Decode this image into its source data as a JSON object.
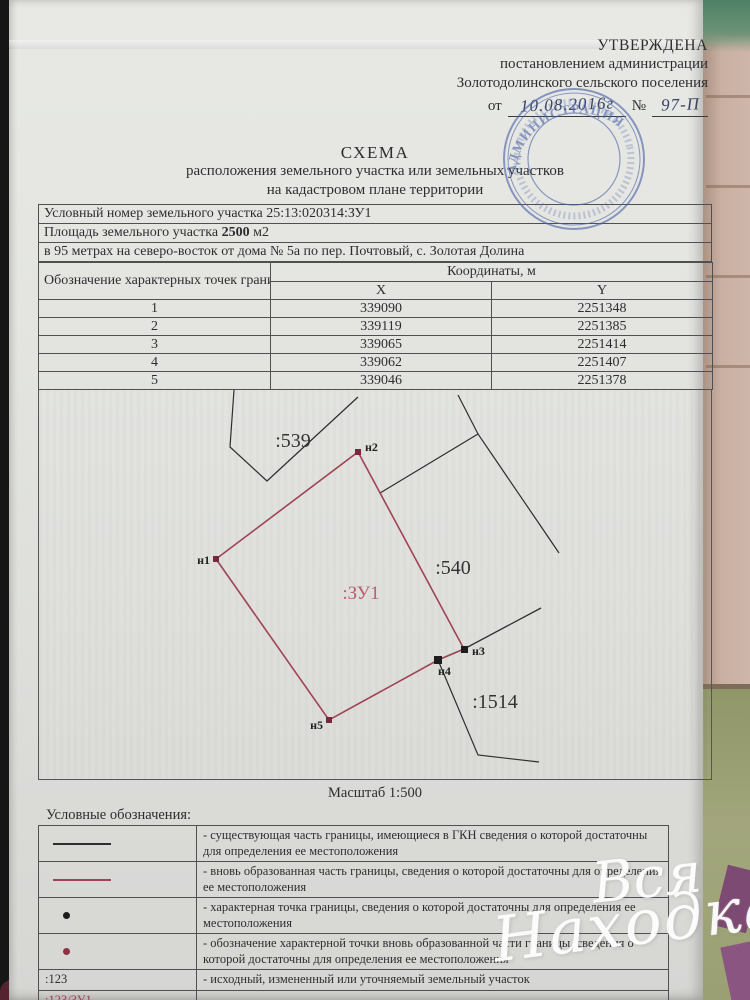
{
  "approval": {
    "line1": "УТВЕРЖДЕНА",
    "line2": "постановлением администрации",
    "line3": "Золотодолинского сельского поселения",
    "prefix": "от",
    "date_handwritten": "10.08.2016г",
    "number_sign": "№",
    "number_handwritten": "97-П"
  },
  "stamp": {
    "center_text": "АДМИНИСТРАЦИЯ",
    "color": "#4c63a8"
  },
  "title": {
    "line1": "СХЕМА",
    "line2": "расположения земельного участка или земельных участков",
    "line3": "на кадастровом плане территории"
  },
  "info": {
    "row1_label": "Условный номер земельного участка",
    "row1_value": "25:13:020314:ЗУ1",
    "row2_label": "Площадь земельного участка",
    "row2_value": "2500",
    "row2_suffix": "м2",
    "row3": "в 95 метрах на северо-восток от дома № 5а по пер. Почтовый, с. Золотая Долина"
  },
  "coords_table": {
    "col1_header": "Обозначение характерных точек границ",
    "col2_header": "Координаты, м",
    "x_header": "X",
    "y_header": "Y",
    "rows": [
      {
        "n": "1",
        "x": "339090",
        "y": "2251348"
      },
      {
        "n": "2",
        "x": "339119",
        "y": "2251385"
      },
      {
        "n": "3",
        "x": "339065",
        "y": "2251414"
      },
      {
        "n": "4",
        "x": "339062",
        "y": "2251407"
      },
      {
        "n": "5",
        "x": "339046",
        "y": "2251378"
      }
    ]
  },
  "plan": {
    "parcel_539": ":539",
    "parcel_540": ":540",
    "parcel_1514": ":1514",
    "new_parcel_label": ":ЗУ1",
    "points": [
      "н1",
      "н2",
      "н3",
      "н4",
      "н5"
    ],
    "scale": "Масштаб 1:500",
    "colors": {
      "new_boundary": "#a04455",
      "existing_boundary": "#2e2e30",
      "new_point": "#76293a",
      "existing_point": "#1d1d1d"
    }
  },
  "legend": {
    "header": "Условные обозначения:",
    "rows": [
      {
        "text": "- существующая часть границы, имеющиеся в ГКН сведения о которой достаточны для определения ее местоположения"
      },
      {
        "text": "- вновь образованная часть границы, сведения о которой достаточны для определения ее местоположения"
      },
      {
        "text": "- характерная точка границы, сведения о которой достаточны для определения ее местоположения"
      },
      {
        "text": "- обозначение характерной точки вновь образованной части границы, сведения о которой достаточны для определения ее местоположения"
      },
      {
        "symbol_text": ":123",
        "text": "- исходный, измененный или уточняемый земельный участок"
      },
      {
        "symbol_line1": ":123/ЗУ1",
        "symbol_line2": ":ЗУ1",
        "text": "- вновь образованный земельный участок"
      }
    ]
  },
  "watermark": {
    "word1": "Вся",
    "word2": "Находка"
  }
}
